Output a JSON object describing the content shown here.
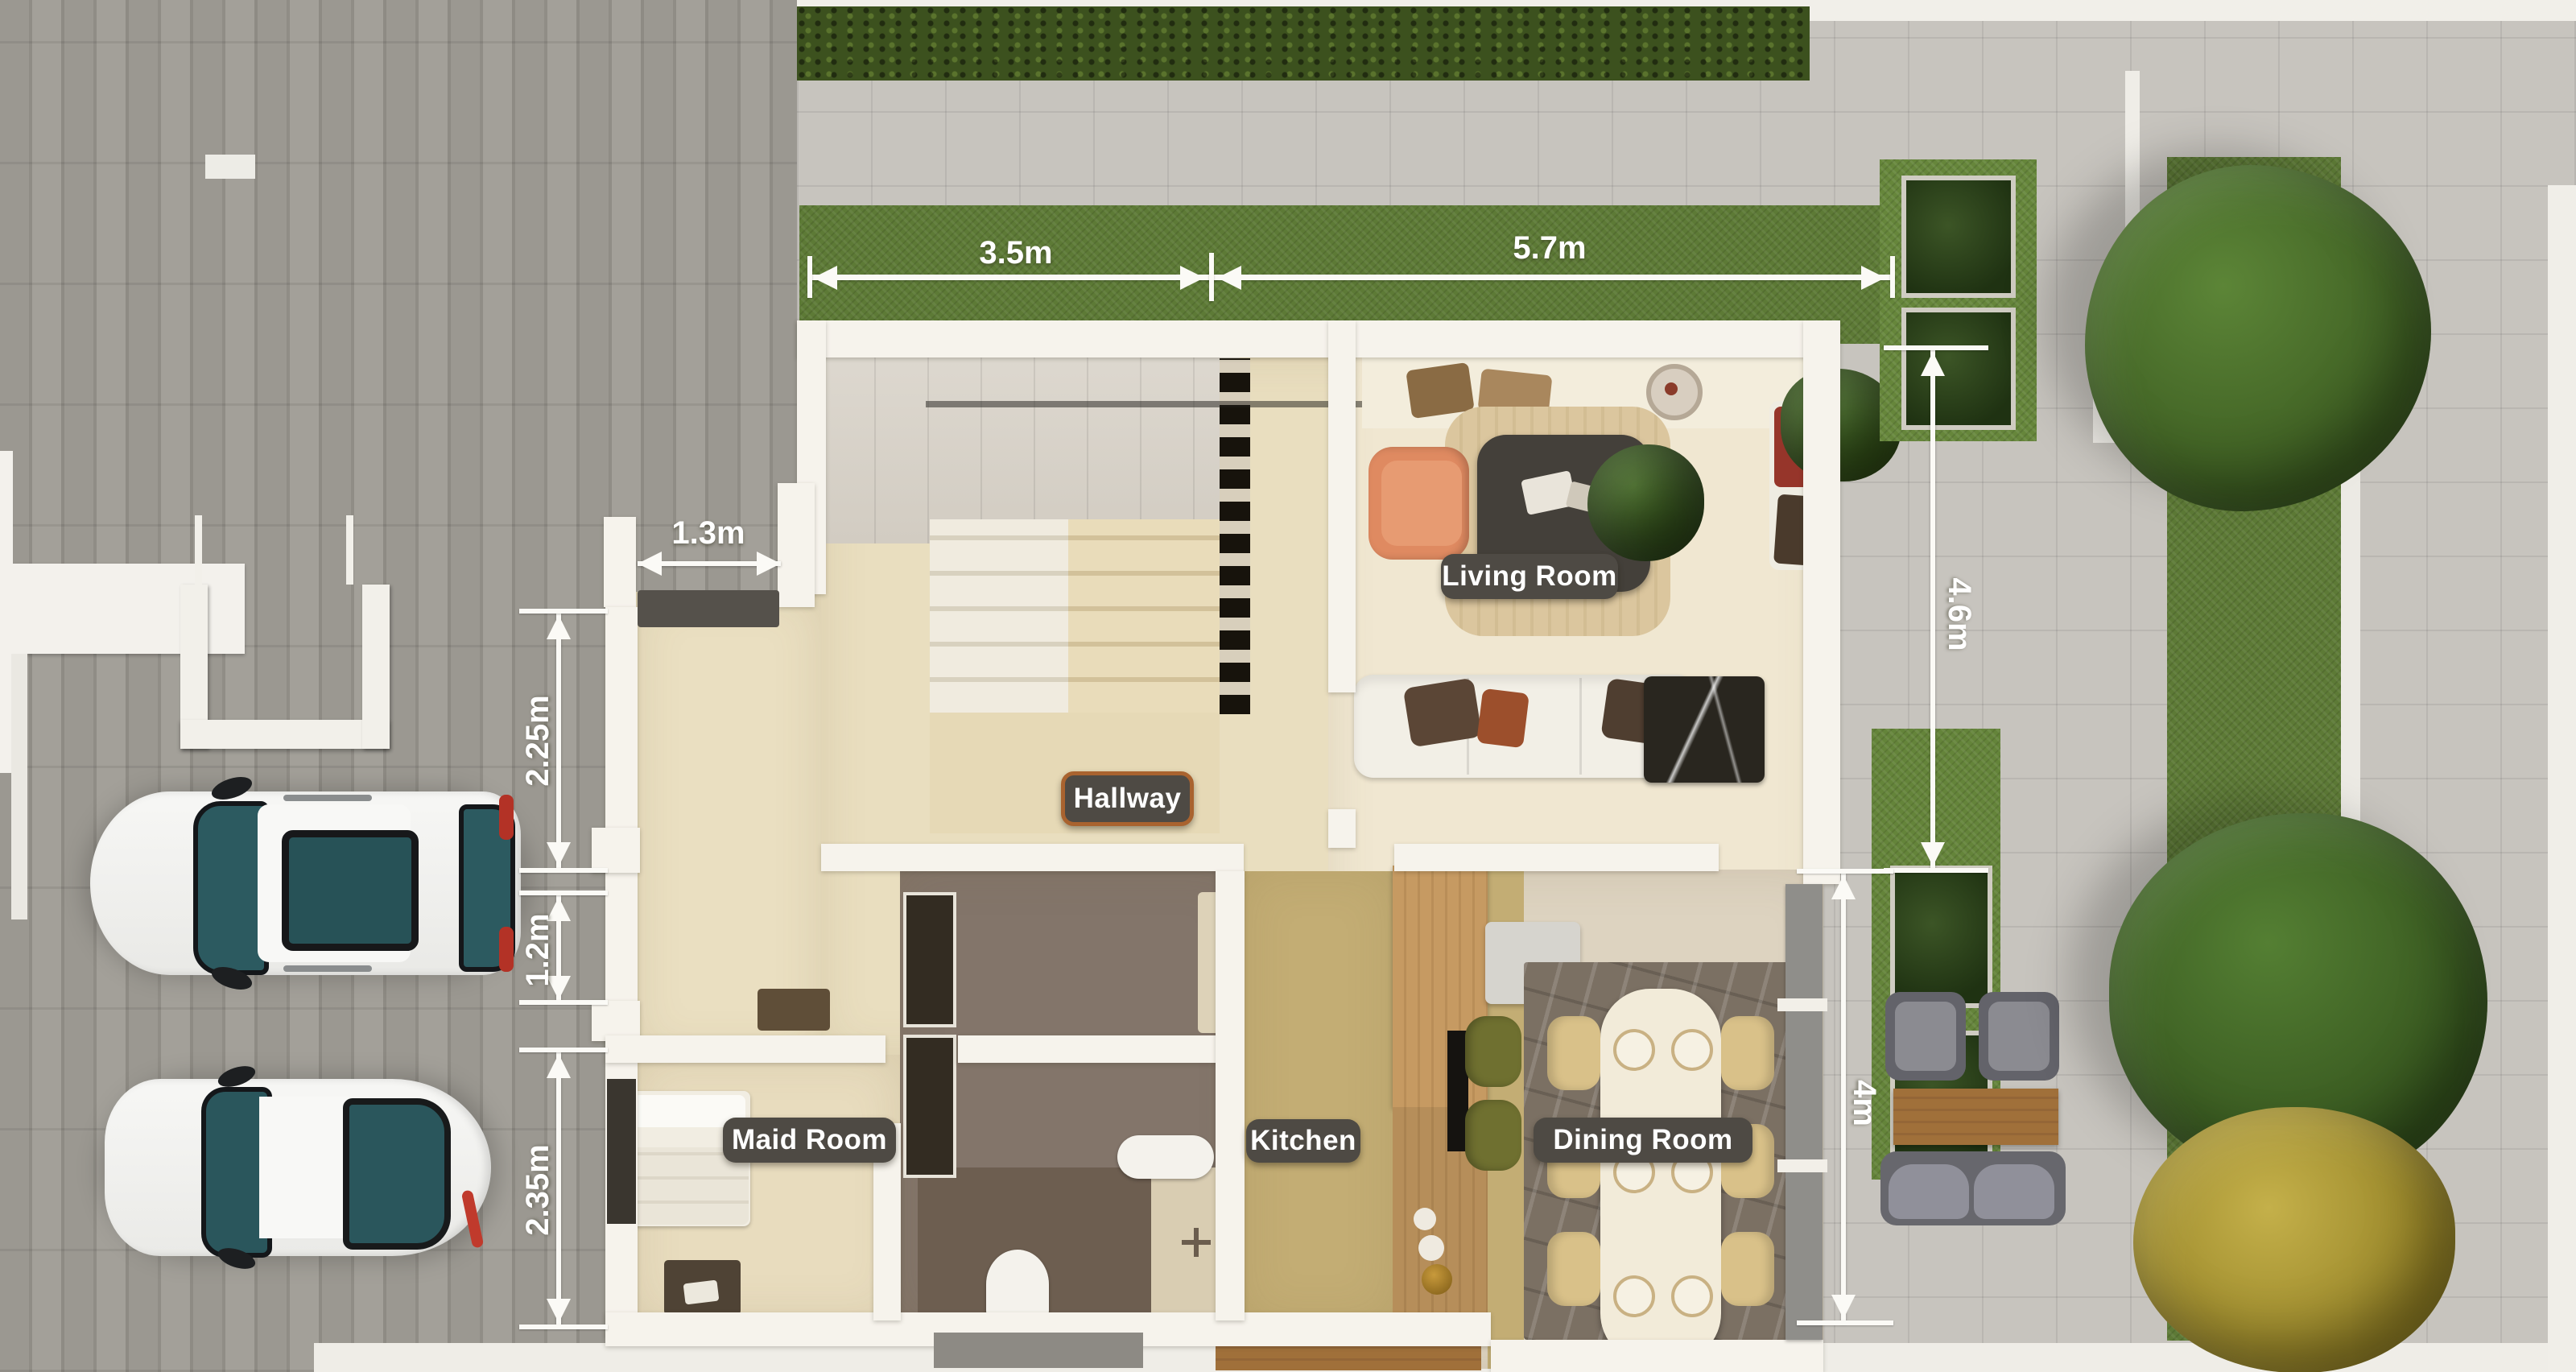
{
  "scene": {
    "type": "3d-floor-plan-top-view",
    "description": "Ground-floor plan render with driveway, two parked cars, front hedge lawn, house interior and right garden terrace"
  },
  "room_labels": {
    "living_room": "Living Room",
    "hallway": "Hallway",
    "maid_room": "Maid Room",
    "kitchen": "Kitchen",
    "dining_room": "Dining Room"
  },
  "dimension_labels": {
    "front_lawn_left": "3.5m",
    "front_lawn_right": "5.7m",
    "entry_door": "1.3m",
    "left_wall_upper": "2.25m",
    "left_wall_middle": "1.2m",
    "left_wall_lower": "2.35m",
    "terrace_upper": "4.6m",
    "terrace_lower": "4m"
  },
  "objects": [
    "suv-car",
    "sedan-car",
    "staircase",
    "louver-screen",
    "entry-mat",
    "orange-armchair",
    "coffee-table",
    "living-rug",
    "white-sofa",
    "marble-side-table",
    "bench-with-red-cushion",
    "indoor-plant",
    "decor-shelf",
    "bed",
    "dresser",
    "wardrobe",
    "toilet",
    "shower",
    "vanity",
    "kitchen-cabinets",
    "kitchen-island",
    "bar-stools-green",
    "dining-table",
    "dining-chairs",
    "plates",
    "outdoor-chairs",
    "outdoor-table",
    "outdoor-sofa",
    "planter-shrubs",
    "green-tree-top",
    "green-tree-middle",
    "yellow-tree-bottom",
    "u-shaped-planter",
    "front-hedge",
    "front-lawn",
    "garden-strip"
  ],
  "colors": {
    "pavement": "#c7c4be",
    "driveway_paver": "#98958f",
    "grass": "#5d7a36",
    "hedge": "#3c511e",
    "wall_white": "#f6f3ec",
    "floor_beige": "#eadfc1",
    "floor_kitchen_olive": "#c3ad74",
    "bathroom_floor": "#83756a",
    "wood_cabinet": "#c69a62",
    "marble_rug": "#7b7063",
    "label_pill": "#4e4a44",
    "hallway_pill_border": "#a9632f",
    "dimension_text": "#ffffff",
    "car_glass_teal": "#2c5a60",
    "armchair_orange": "#df8a61",
    "tree_green": "#3f6023",
    "tree_yellow": "#b7a336"
  }
}
